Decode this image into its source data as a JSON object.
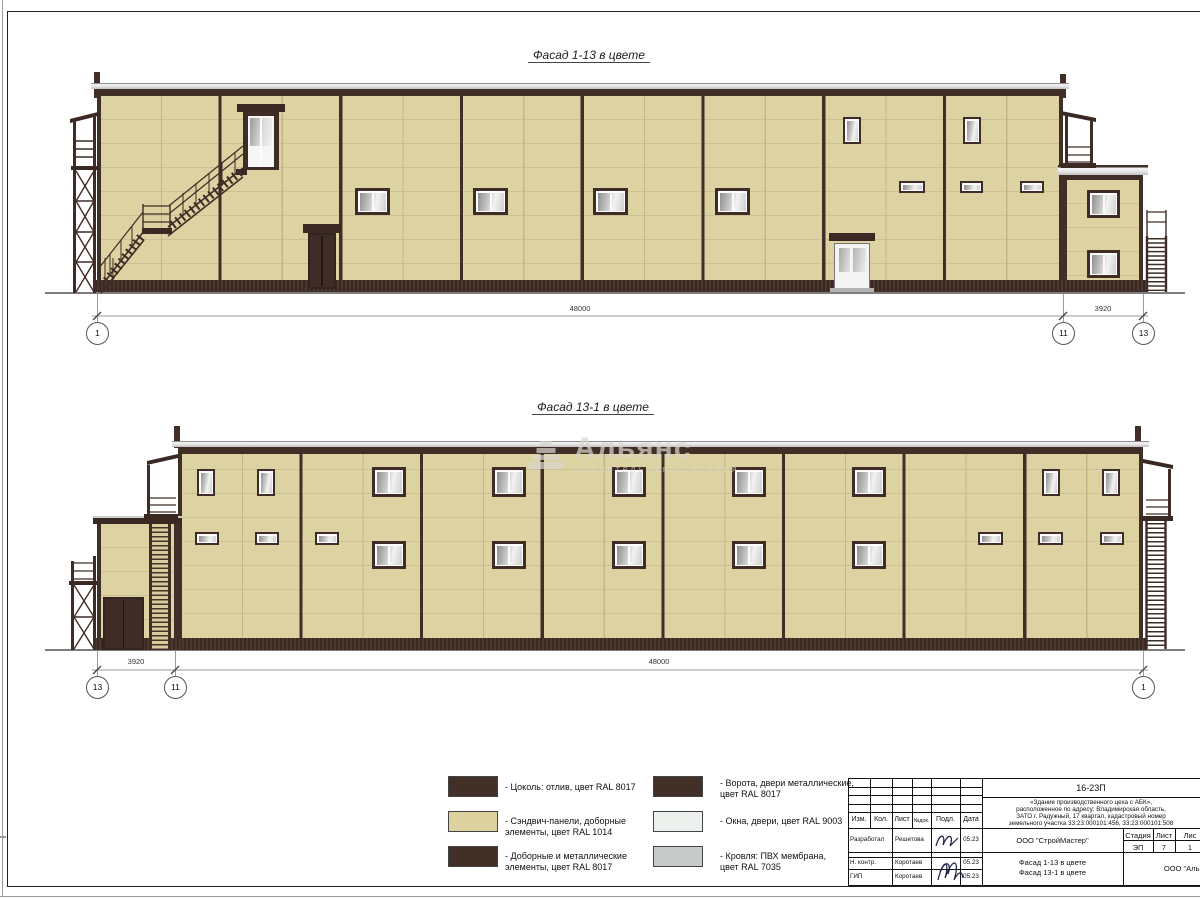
{
  "sheet": {
    "facade1": {
      "title": "Фасад 1-13 в цвете",
      "dim_main": "48000",
      "dim_side": "3920",
      "axis_left": "1",
      "axis_mid": "11",
      "axis_right": "13"
    },
    "facade2": {
      "title": "Фасад 13-1 в цвете",
      "dim_main": "48000",
      "dim_side": "3920",
      "axis_left": "13",
      "axis_mid": "11",
      "axis_right": "1"
    },
    "watermark": {
      "name": "Альянс",
      "subtitle": "строительная компания"
    },
    "legend": {
      "items": [
        {
          "color": "#422f28",
          "line1": "- Цоколь: отлив, цвет RAL 8017",
          "line2": ""
        },
        {
          "color": "#ddd1a0",
          "line1": "- Сэндвич-панели, доборные",
          "line2": "элементы, цвет RAL 1014"
        },
        {
          "color": "#422f28",
          "line1": "- Доборные и металлические",
          "line2": "элементы, цвет RAL 8017"
        },
        {
          "color": "#422f28",
          "line1": "- Ворота, двери металлические,",
          "line2": "цвет RAL 8017"
        },
        {
          "color": "#edf1ed",
          "line1": "- Окна, двери, цвет RAL 9003",
          "line2": ""
        },
        {
          "color": "#c6cbc9",
          "line1": "- Кровля: ПВХ мембрана,",
          "line2": "цвет RAL 7035"
        }
      ]
    },
    "titleblock": {
      "doc_number": "16-23П",
      "desc": [
        "«Здание производственного цеха с АБК»,",
        "расположенное по адресу: Владимирская область,",
        "ЗАТО г. Радужный, 17 квартал, кадастровый номер",
        "земельного участка 33:23:000101:456, 33:23:000101:508"
      ],
      "columns": [
        "Изм.",
        "Кол.",
        "Лист",
        "№док.",
        "Подл.",
        "Дата"
      ],
      "rows": [
        {
          "role": "Разработал",
          "name": "Решетова",
          "date": "05.23"
        },
        {
          "role": "Н. контр.",
          "name": "Коротаев",
          "date": "05.23"
        },
        {
          "role": "ГИП",
          "name": "Коротаев",
          "date": "05.23"
        }
      ],
      "org": "ООО \"СтройМастер\"",
      "org2": "ООО \"Альянс\"",
      "stage_label": "Стадия",
      "sheet_label": "Лист",
      "sheets_label": "Лис",
      "stage": "ЭП",
      "sheet_num": "7",
      "sheets_num": "1",
      "titles": [
        "Фасад 1-13 в цвете",
        "Фасад 13-1 в цвете"
      ]
    }
  }
}
